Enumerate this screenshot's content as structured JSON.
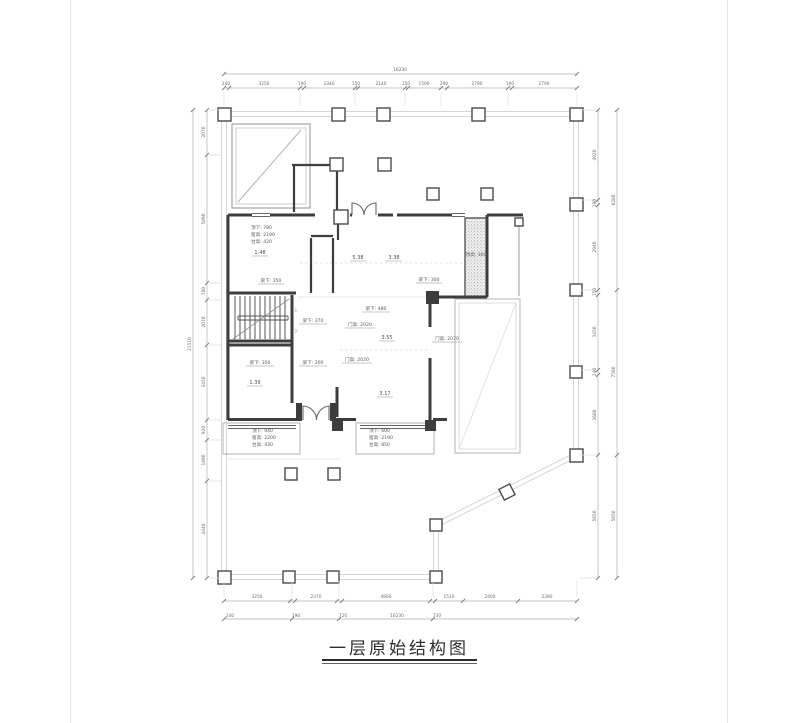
{
  "page": {
    "title": "一层原始结构图"
  },
  "levels": {
    "a": "1.48",
    "b": "5.38",
    "c": "3.38",
    "d": "3.55",
    "e": "1.39",
    "f": "3.17"
  },
  "notes": {
    "beam_350_a": "梁下: 350",
    "beam_350_b": "梁下: 350",
    "beam_300": "梁下: 300",
    "beam_480": "梁下: 480",
    "beam_370": "梁下: 370",
    "beam_200": "梁下: 200",
    "door_2020_a": "门高: 2020",
    "door_2020_b": "门高: 2020",
    "door_2070": "门高: 2070",
    "ceiling_300": "顶高: 300"
  },
  "stair": {
    "up": "上",
    "down": "下"
  },
  "window_blocks": {
    "top_left": {
      "l1": "顶下: 780",
      "l2": "窗高: 2190",
      "l3": "台高: 420"
    },
    "bottom_left": {
      "l1": "顶下: 940",
      "l2": "窗高: 2200",
      "l3": "台高: 430"
    },
    "bottom_right": {
      "l1": "顶下: 600",
      "l2": "窗高: 2190",
      "l3": "台高: 850"
    }
  },
  "dimensions": {
    "top": {
      "overall": "16230",
      "segments": [
        "240",
        "3250",
        "190",
        "2340",
        "150",
        "2140",
        "150",
        "1500",
        "290",
        "2790",
        "190",
        "2790"
      ]
    },
    "bottom": {
      "overall": "16230",
      "segments": [
        "3250",
        "2370",
        "4660",
        "1510",
        "2400",
        "2390"
      ],
      "offsets": [
        "240",
        "190",
        "720",
        "730"
      ]
    },
    "left": {
      "overall": "21510",
      "segments": [
        "2070",
        "5890",
        "780",
        "2070",
        "3450",
        "920",
        "1890",
        "4440"
      ]
    },
    "right": {
      "inner_segments": [
        "4920",
        "190",
        "2940",
        "150",
        "3450",
        "240",
        "3680",
        "5650"
      ],
      "outer_segments": [
        "8280",
        "7590",
        "5650"
      ]
    }
  }
}
